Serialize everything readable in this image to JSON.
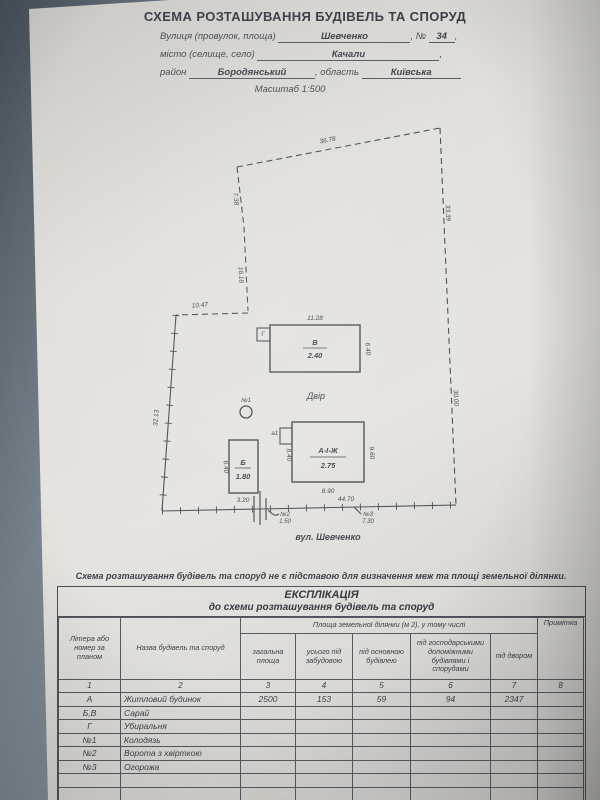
{
  "title": "СХЕМА РОЗТАШУВАННЯ БУДІВЕЛЬ ТА СПОРУД",
  "form": {
    "street_label": "Вулиця (провулок, площа)",
    "street_value": "Шевченко",
    "number_label": ", №",
    "number_value": "34",
    "comma": ",",
    "city_label": "місто (селище, село)",
    "city_value": "Качали",
    "district_label": "район",
    "district_value": "Бородянський",
    "region_label": ", область",
    "region_value": "Київська",
    "scale": "Масштаб  1:500"
  },
  "plan": {
    "dims": {
      "top": "36.78",
      "right_upper": "33.39",
      "right_lower": "30.00",
      "left_upper": "7.38",
      "left_mid": "16.18",
      "step": "10.47",
      "left_lower": "32.13",
      "bottom": "44.70"
    },
    "shed_v": {
      "letter": "В",
      "height": "2.40",
      "top_dim": "11.28",
      "side_dim": "6.40",
      "annex": "Г"
    },
    "shed_b": {
      "letter": "Б",
      "height": "1.80",
      "bottom_dim": "3.20",
      "side_dim": "6.40"
    },
    "house": {
      "letter": "А-І-Ж",
      "height": "2.75",
      "bottom_dim": "8.90",
      "left_dim": "8.40",
      "right_dim": "9.60",
      "annex": "а1"
    },
    "well_label": "№1",
    "yard_label": "Двір",
    "gate_label": "№2",
    "gate_dim": "1.50",
    "fence_label": "№3",
    "fence_dim": "7.30",
    "street_name": "вул. Шевченко"
  },
  "disclaimer": "Схема розташування будівель та споруд не є підставою для визначення меж та площі  земельної ділянки.",
  "table": {
    "title": "ЕКСПЛІКАЦІЯ",
    "subtitle": "до схеми розташування будівель та споруд",
    "headers": {
      "col1": "Літера або номер за планом",
      "col2": "Назва будівель та споруд",
      "area_group": "Площа земельної ділянки (м 2), у тому числі",
      "col3": "загальна площа",
      "col4": "усього під забудовою",
      "col5": "під основною будівлею",
      "col6": "під господарськими допоміжними будівлями і спорудами",
      "col7": "під двором",
      "col8": "Примітка"
    },
    "number_row": [
      "1",
      "2",
      "3",
      "4",
      "5",
      "6",
      "7",
      "8"
    ],
    "rows": [
      {
        "cells": [
          "А",
          "Житловий будинок",
          "2500",
          "153",
          "59",
          "94",
          "2347",
          ""
        ]
      },
      {
        "cells": [
          "Б,В",
          "Сарай",
          "",
          "",
          "",
          "",
          "",
          ""
        ]
      },
      {
        "cells": [
          "Г",
          "Убиральня",
          "",
          "",
          "",
          "",
          "",
          ""
        ]
      },
      {
        "cells": [
          "№1",
          "Колодязь",
          "",
          "",
          "",
          "",
          "",
          ""
        ]
      },
      {
        "cells": [
          "№2",
          "Ворота з хвірткою",
          "",
          "",
          "",
          "",
          "",
          ""
        ]
      },
      {
        "cells": [
          "№3",
          "Огорожа",
          "",
          "",
          "",
          "",
          "",
          ""
        ]
      },
      {
        "cells": [
          "",
          "",
          "",
          "",
          "",
          "",
          "",
          ""
        ]
      },
      {
        "cells": [
          "",
          "",
          "",
          "",
          "",
          "",
          "",
          ""
        ]
      }
    ]
  }
}
